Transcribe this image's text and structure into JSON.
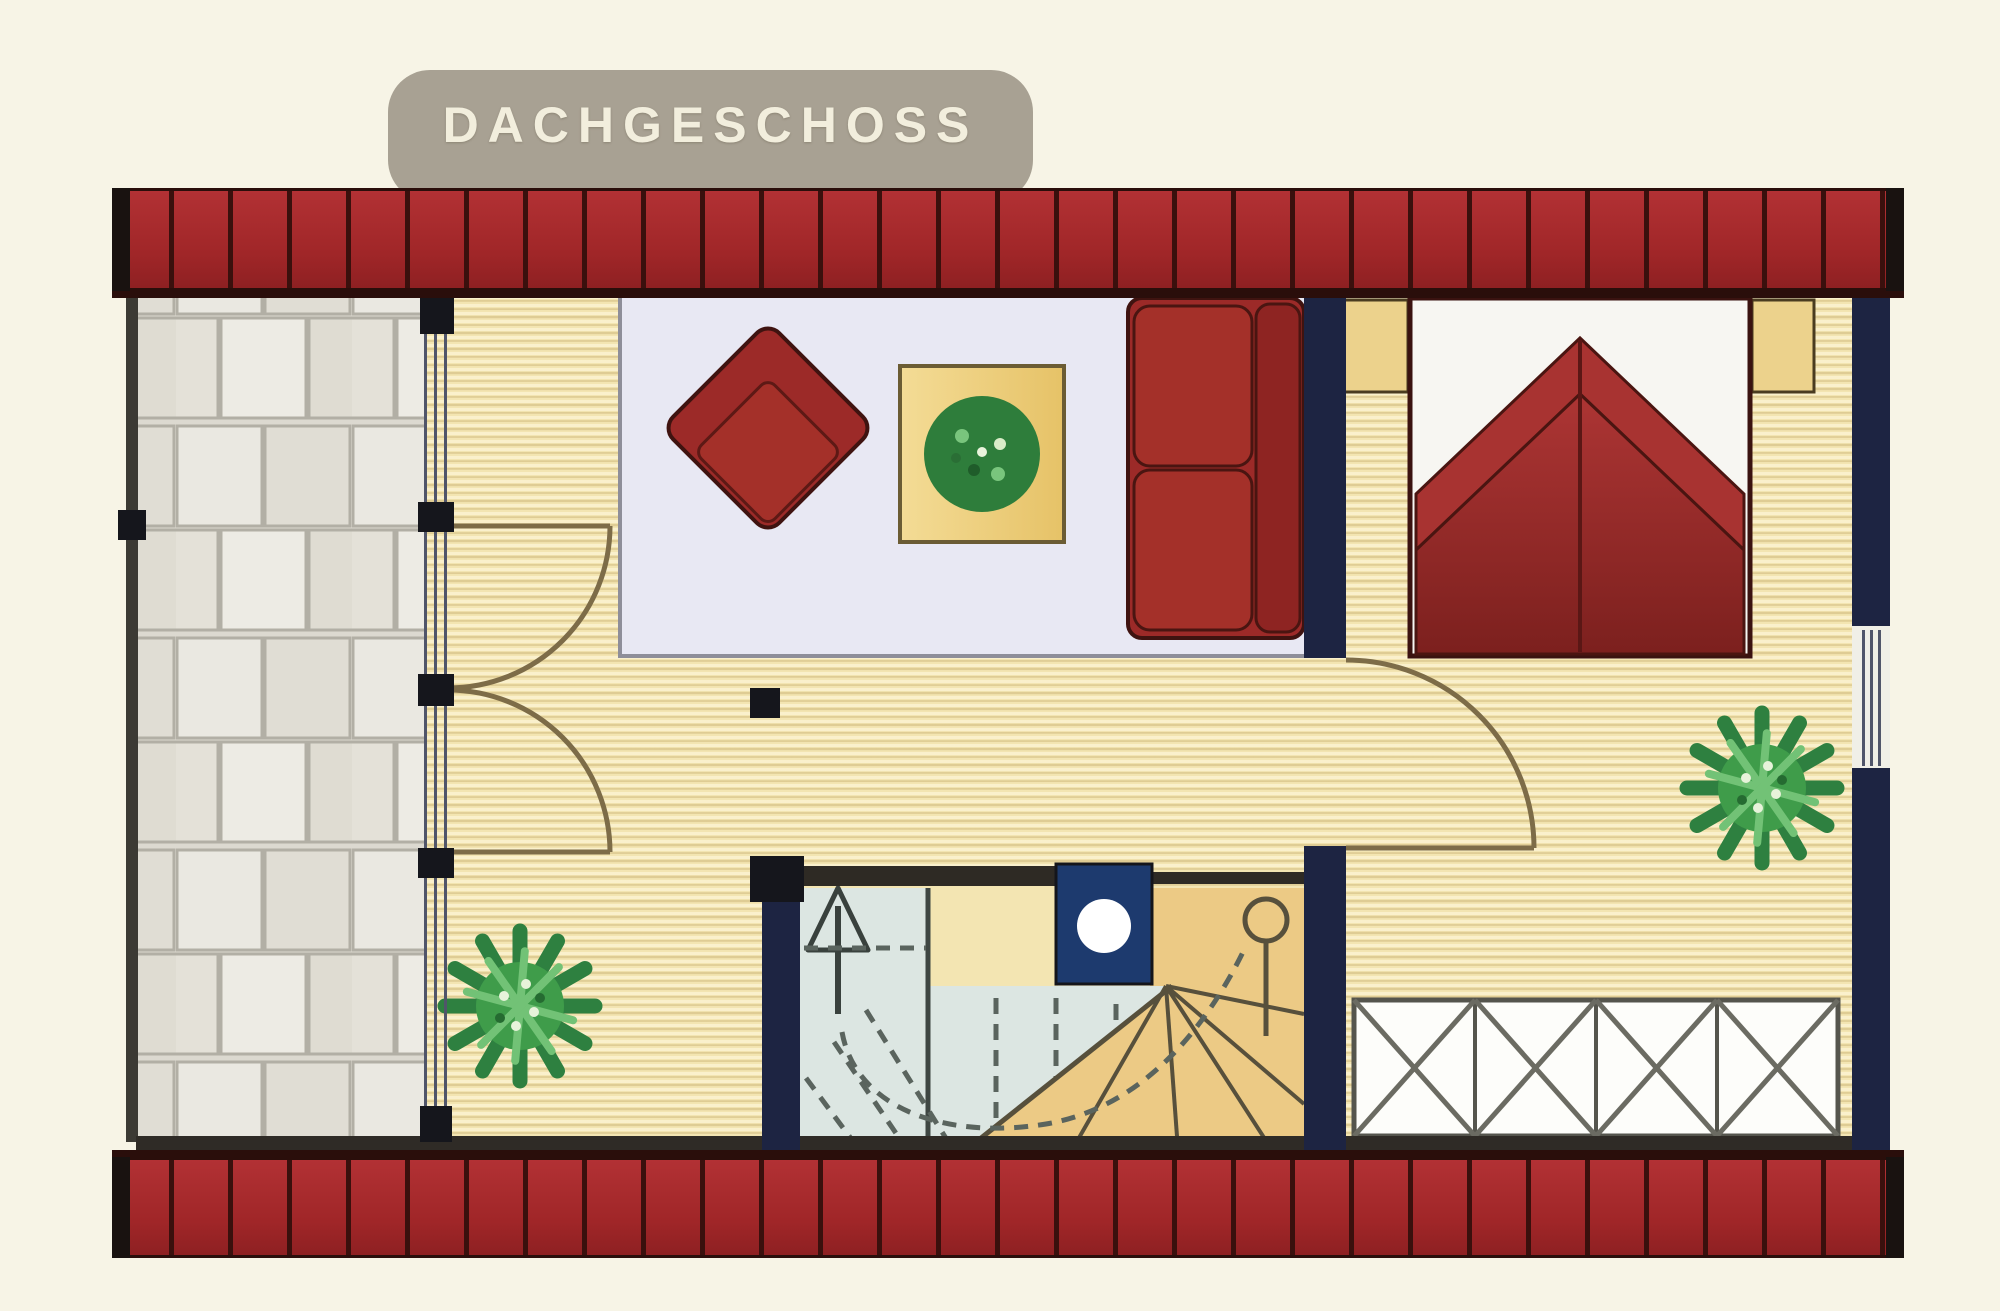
{
  "title": {
    "label": "DACHGESCHOSS"
  },
  "palette": {
    "background": "#f7f4e6",
    "banner_gray": "#a8a193",
    "roof_red": "#a22729",
    "wall_navy": "#1d2442",
    "wood_floor": "#f3e5b2",
    "terrace_tile": "#e5e2da",
    "rug": "#e8e8f3",
    "furniture_red": "#9c2a28",
    "bed_blanket": "#a53130",
    "stair_blue": "#dce6e2",
    "stair_tan": "#ecca85",
    "chimney_blue": "#1d3a6e",
    "plant_green": "#3f9c4a"
  },
  "elements": {
    "banner": "floor-title-banner",
    "rooms": [
      "terrace",
      "living-area",
      "bedroom",
      "stairwell"
    ],
    "furniture": [
      "armchair",
      "coffee-table-with-plant",
      "sofa",
      "double-bed",
      "nightstand-left",
      "nightstand-right",
      "wardrobe-radiator",
      "potted-plant-living",
      "potted-plant-bedroom",
      "chimney-block",
      "winder-staircase"
    ]
  }
}
